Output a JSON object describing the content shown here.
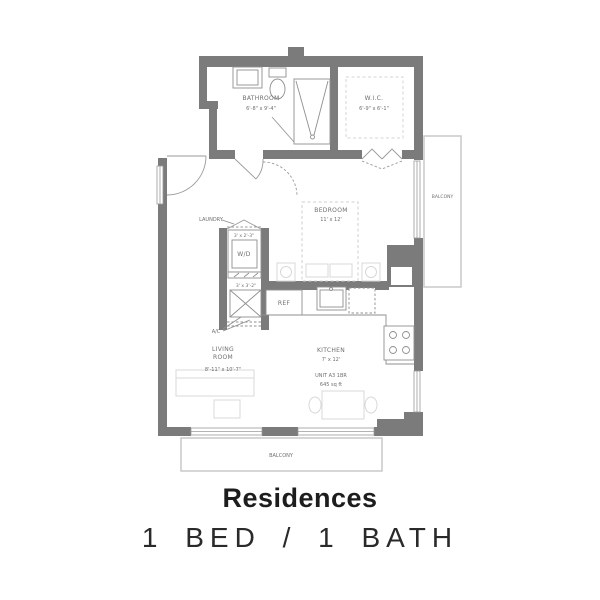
{
  "caption": {
    "title": "Residences",
    "subtitle": "1 BED / 1 BATH"
  },
  "floorplan": {
    "bathroom": {
      "name": "BATHROOM",
      "dims": "6'-8\" x 9'-4\""
    },
    "wic": {
      "name": "W.I.C.",
      "dims": "6'-9\" x 6'-1\""
    },
    "bedroom": {
      "name": "BEDROOM",
      "dims": "11' x 12'"
    },
    "laundry": {
      "label": "LAUNDRY",
      "dims": "3' x 2'-3\"",
      "appliance": "W/D"
    },
    "ac": {
      "label": "A/C",
      "dims": "3' x 3'-2\""
    },
    "kitchen": {
      "name": "KITCHEN",
      "dims": "7' x 12'"
    },
    "living": {
      "name_line1": "LIVING",
      "name_line2": "ROOM",
      "dims": "8'-11\" x 10'-7\""
    },
    "unit": {
      "line1": "UNIT A3 1BR",
      "line2": "645 sq ft"
    },
    "ref_label": "REF",
    "balcony_right": "BALCONY",
    "balcony_bottom": "BALCONY"
  },
  "colors": {
    "wall": "#7b7b7b",
    "fixture": "#8f8f8f",
    "door": "#9a9a9a",
    "faint_furniture": "#d8d8d8",
    "balcony_border": "#c9c9c9",
    "plan_text": "#6f6f6f",
    "caption_text": "#1d1d1d",
    "background": "#ffffff"
  }
}
